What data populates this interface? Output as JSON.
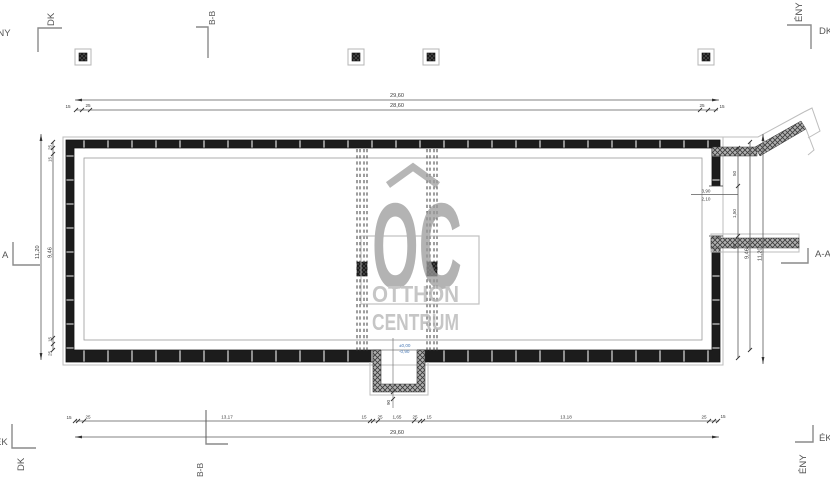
{
  "drawing": {
    "watermark": {
      "letters": "OC",
      "word1": "OTTHON",
      "word2": "CENTRUM"
    },
    "orientation": {
      "tl_v": "DK",
      "tl_h": "ÉNY",
      "tr_v": "ÉNY",
      "tr_h": "DK",
      "bl_v": "DK",
      "bl_h": "ÉK",
      "br_v": "ÉNY",
      "br_h": "ÉK"
    },
    "sections": {
      "top": "B-B",
      "bottom": "B-B",
      "left": "A",
      "right": "A-A"
    },
    "dims": {
      "top_overall": "29,60",
      "top_clear": "28,60",
      "bottom_overall": "29,60",
      "bottom_segments": [
        "15",
        "25",
        "13,17",
        "15",
        "25",
        "1,65",
        "25",
        "15",
        "13,18",
        "25",
        "15"
      ],
      "left_overall": "11,20",
      "left_clear": "9,46",
      "left_ticks_top_a": "25",
      "left_ticks_top_b": "15",
      "left_ticks_bot_a": "15",
      "left_ticks_bot_b": "25",
      "right_overall": "11,20",
      "right_clear": "9,46",
      "right_seg_a": "50",
      "right_seg_b": "1,50",
      "right_seg_c": "60",
      "opening_top": "3,90",
      "opening_bottom": "2,10",
      "top_end_left_a": "15",
      "top_end_left_b": "25",
      "top_end_right_a": "25",
      "top_end_right_b": "15",
      "stair_width": "90"
    },
    "elevations": {
      "line1": "±0,00",
      "line2": "-0,90"
    },
    "colors": {
      "wall": "#1c1c1c",
      "hatch_gray": "#b0b0b0",
      "dim_line": "#5a5a5a",
      "watermark_gray": "#9a9a9a",
      "elevation_blue": "#4a7ab5",
      "outline_gray": "#bdbdbd"
    }
  }
}
